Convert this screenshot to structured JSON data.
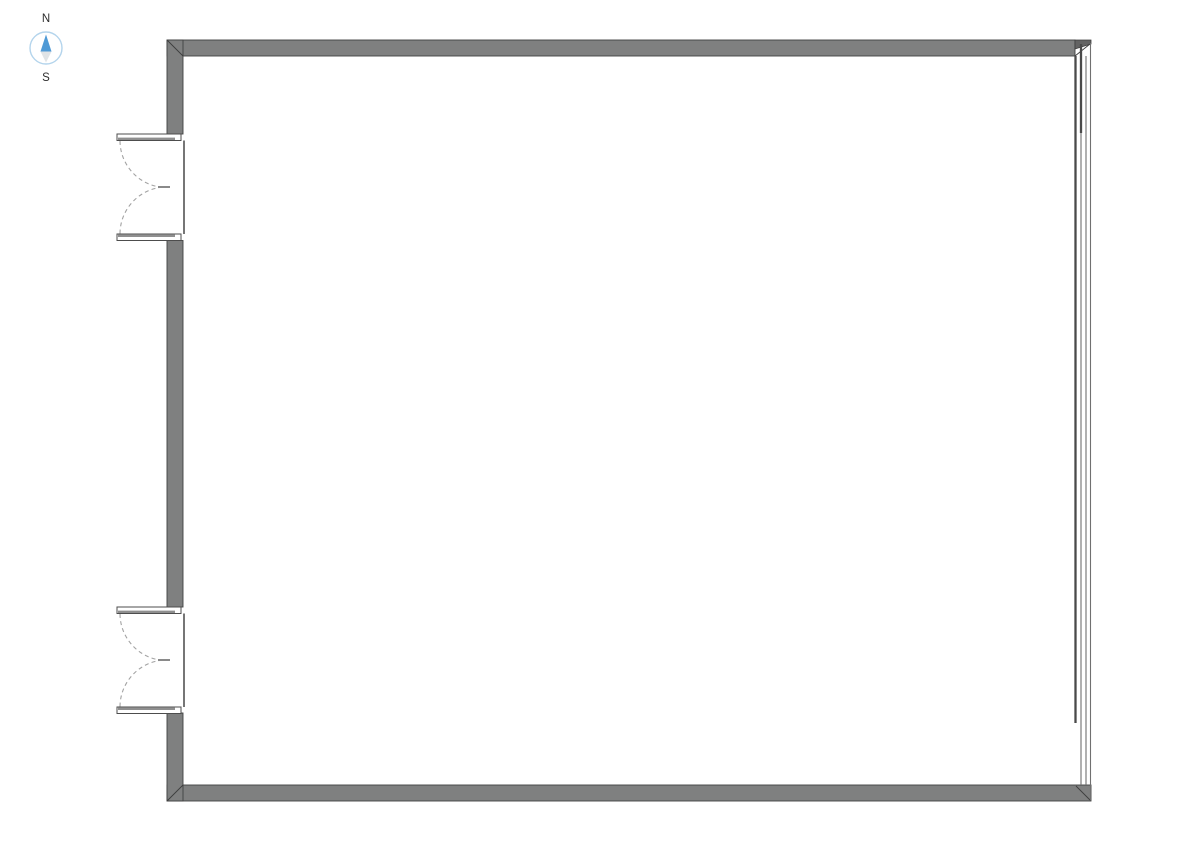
{
  "page": {
    "background_color": "#ffffff",
    "description": "Architectural floor plan of a single large rectangular room"
  },
  "compass": {
    "north_label": "N",
    "south_label": "S",
    "colors": {
      "ring": "#b3d4ec",
      "north_arrow": "#4f9ad6",
      "south_arrow": "#dfe3e6",
      "label": "#2e2e2e"
    }
  },
  "floor_plan": {
    "colors": {
      "wall_fill": "#7f8080",
      "wall_outline": "#414141",
      "door_swing_arc": "#a3a3a3",
      "glazing_line": "#707070",
      "glazing_panel": "#4a4a4a"
    },
    "walls": [
      {
        "id": "north-wall",
        "type": "solid"
      },
      {
        "id": "south-wall",
        "type": "solid"
      },
      {
        "id": "west-wall",
        "type": "solid",
        "openings": 2
      },
      {
        "id": "east-wall",
        "type": "glazed-sliding"
      }
    ],
    "doors": [
      {
        "id": "west-double-door-upper",
        "type": "double-swing",
        "swing": "outward-west"
      },
      {
        "id": "west-double-door-lower",
        "type": "double-swing",
        "swing": "outward-west"
      }
    ]
  }
}
